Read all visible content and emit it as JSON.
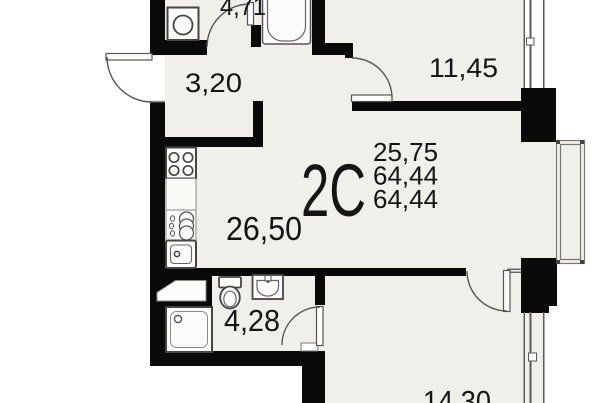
{
  "unit": {
    "type_label": "2С",
    "living_area": "25,75",
    "total_area": "64,44",
    "total_area_2": "64,44"
  },
  "rooms": [
    {
      "name": "bathroom-top",
      "area": "4,71"
    },
    {
      "name": "hallway",
      "area": "3,20"
    },
    {
      "name": "bedroom-top",
      "area": "11,45"
    },
    {
      "name": "kitchen-living-room",
      "area": "26,50"
    },
    {
      "name": "bathroom-bottom",
      "area": "4,28"
    },
    {
      "name": "bedroom-bottom",
      "area": "14,30"
    }
  ],
  "fixtures": [
    "washing-machine-icon",
    "bathtub-icon",
    "stove-icon",
    "water-heater-icon",
    "kitchen-sink-icon",
    "vent-duct-icon",
    "toilet-icon",
    "washbasin-icon",
    "shower-icon"
  ],
  "openings": [
    "entrance-door",
    "bathroom-top-door",
    "bedroom-top-door",
    "bathroom-bottom-door",
    "bedroom-bottom-door",
    "window-top-right",
    "window-bottom-right",
    "loggia-railing"
  ],
  "colors": {
    "floor": "#f0efe9",
    "wall": "#0a0a0a",
    "fixture_stroke": "#454545",
    "text": "#141414"
  }
}
